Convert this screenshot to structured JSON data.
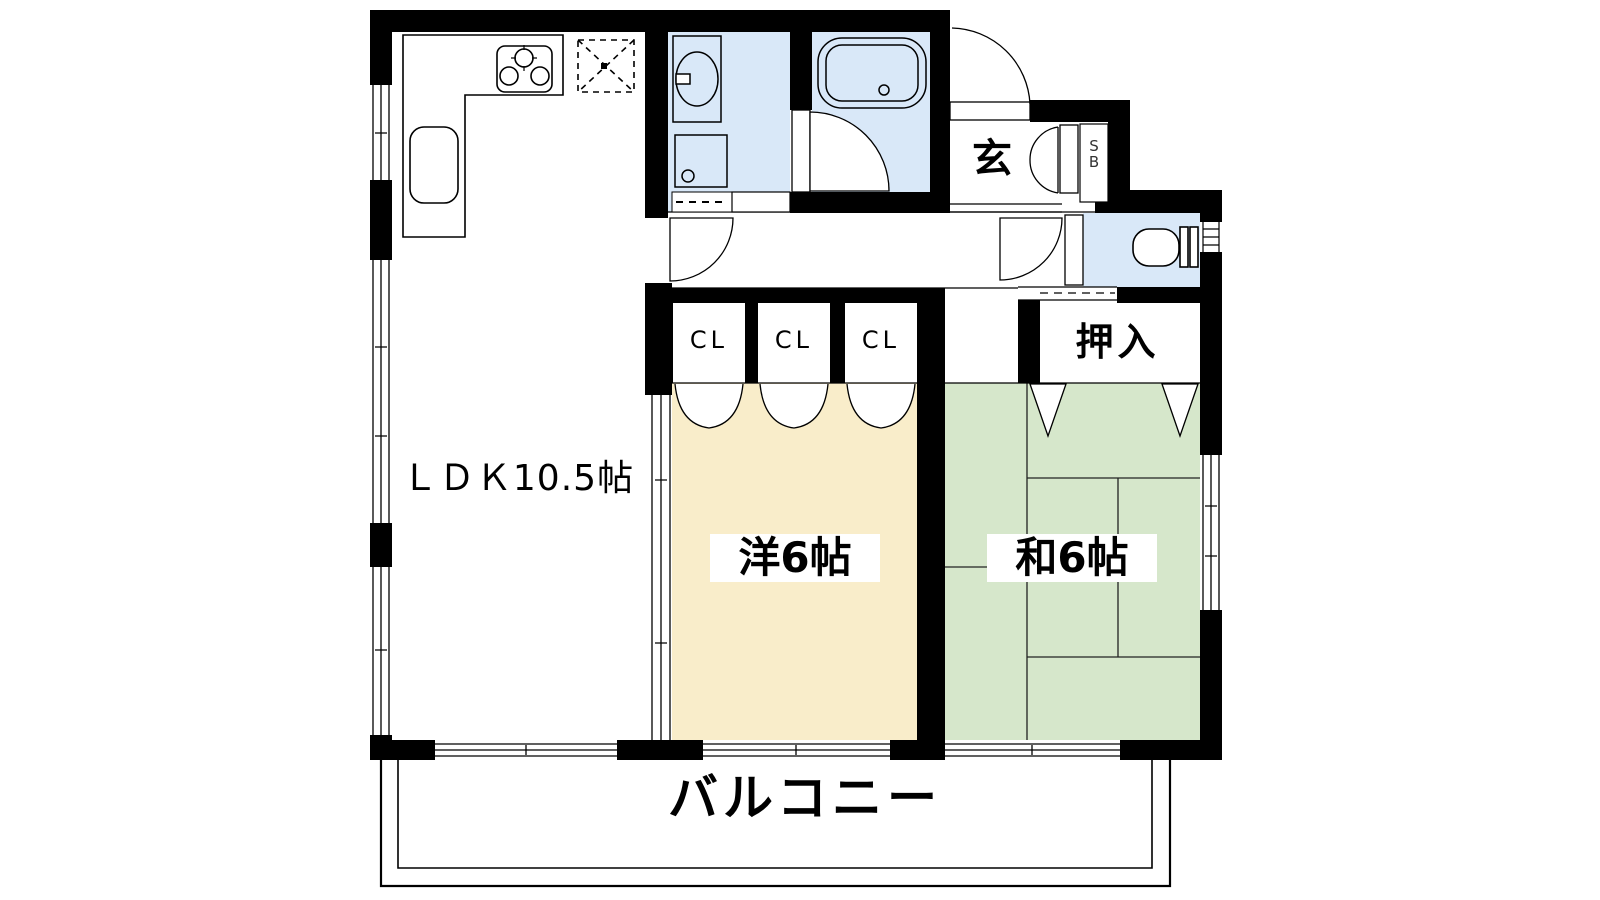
{
  "plan": {
    "type": "apartment-floor-plan",
    "rooms": {
      "ldk": "ＬＤＫ10.5帖",
      "western": "洋6帖",
      "japanese": "和6帖",
      "closet1": "CL",
      "closet2": "CL",
      "closet3": "CL",
      "oshiire": "押入",
      "entrance": "玄",
      "shoebox_line1": "S",
      "shoebox_line2": "B",
      "balcony": "バルコニー"
    },
    "colors": {
      "wall": "#000000",
      "water_area": "#D9E8F8",
      "western_room": "#F9EDCA",
      "japanese_room": "#D6E7CB",
      "line": "#000000"
    }
  }
}
